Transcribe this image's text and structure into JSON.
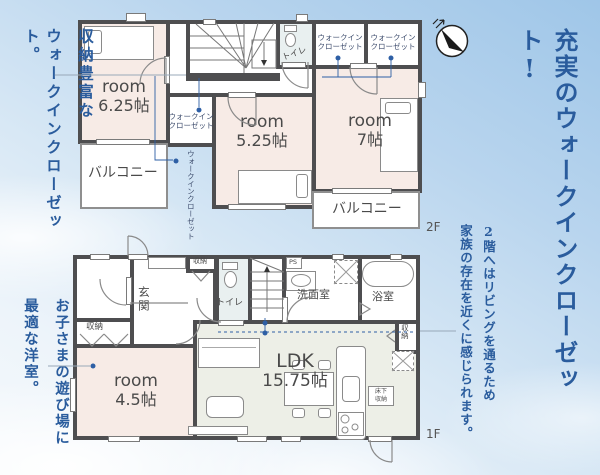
{
  "palette": {
    "caption_blue": "#2a5c9d",
    "wall": "#4e4e50",
    "room_pink": "#f7ebe6",
    "ldk_green": "#edefe7",
    "dot_blue": "#2e5fa5"
  },
  "captions": {
    "left_top_1": "収納豊富な",
    "left_top_2": "ウォークインクローゼット。",
    "left_bottom_1": "お子さまの遊び場に",
    "left_bottom_2": "最適な洋室。",
    "right_main_1": "2階全居室には、",
    "right_main_2": "充実のウォークインクローゼット!",
    "right_sub_1": "2階へはリビングを通るため",
    "right_sub_2": "家族の存在を近くに感じられます。"
  },
  "floor2": {
    "floor_label": "2F",
    "room1_name": "room",
    "room1_size": "6.25帖",
    "room2_name": "room",
    "room2_size": "5.25帖",
    "room3_name": "room",
    "room3_size": "7帖",
    "wic_line1": "ウォークイン",
    "wic_line2": "クローゼット",
    "balcony": "バルコニー",
    "toilet": "トイレ"
  },
  "floor1": {
    "floor_label": "1F",
    "entrance": "玄関",
    "storage": "収納",
    "toilet": "トイレ",
    "washroom": "洗面室",
    "bath": "浴室",
    "ps": "PS",
    "room_name": "room",
    "room_size": "4.5帖",
    "ldk_name": "LDK",
    "ldk_size": "15.75帖",
    "underfloor_1": "床下",
    "underfloor_2": "収納"
  }
}
